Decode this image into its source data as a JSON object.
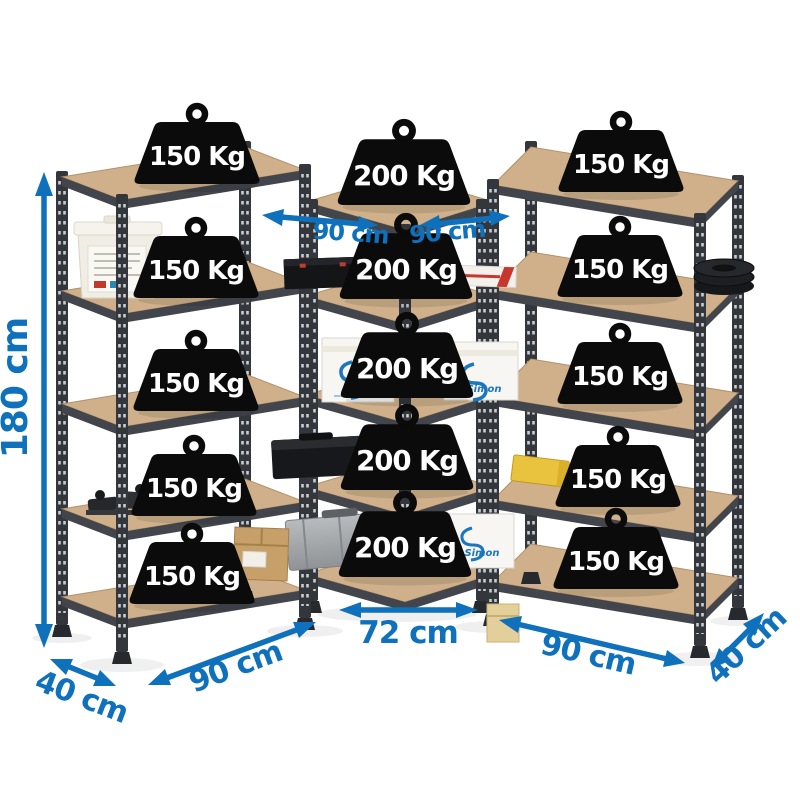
{
  "units": {
    "left": {
      "capacities": [
        "150 Kg",
        "150 Kg",
        "150 Kg",
        "150 Kg",
        "150 Kg"
      ]
    },
    "center": {
      "capacities": [
        "200 Kg",
        "200 Kg",
        "200 Kg",
        "200 Kg",
        "200 Kg"
      ]
    },
    "right": {
      "capacities": [
        "150 Kg",
        "150 Kg",
        "150 Kg",
        "150 Kg",
        "150 Kg"
      ]
    }
  },
  "dimensions": {
    "height": "180 cm",
    "width_top_left": "90 cm",
    "width_top_right": "90 cm",
    "width_bottom_left": "90 cm",
    "depth_bottom_left": "40 cm",
    "span_bottom_center": "72 cm",
    "width_bottom_right": "90 cm",
    "depth_bottom_right": "40 cm"
  },
  "items": {
    "box_brand": "Simon"
  },
  "colors": {
    "dimension_blue": "#0f71bc",
    "weight_black": "#0b0b0b",
    "frame_gray": "#33363b",
    "wood_tan": "#cfb08a"
  }
}
